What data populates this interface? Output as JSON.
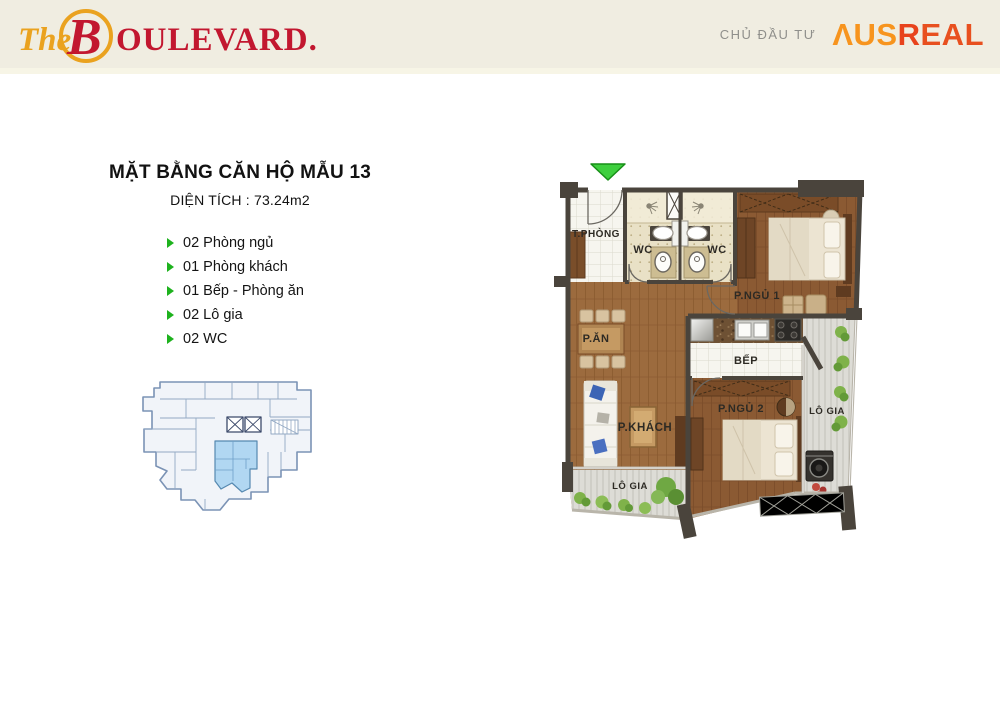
{
  "header": {
    "logo_the": "The",
    "logo_b": "B",
    "logo_rest": "OULEVARD.",
    "developer_label": "CHỦ ĐẦU TƯ",
    "developer_aus": "ΛUS",
    "developer_r": "R",
    "developer_eal": "EAL"
  },
  "title": {
    "main": "MẶT BẰNG CĂN HỘ MẪU 13",
    "area": "DIỆN TÍCH : 73.24m2"
  },
  "features": [
    "02 Phòng ngủ",
    "01 Phòng khách",
    "01 Bếp - Phòng ăn",
    "02 Lô gia",
    "02 WC"
  ],
  "floor_plan": {
    "rooms": {
      "entry": "T.PHÒNG",
      "wc_left": "WC",
      "wc_right": "WC",
      "bedroom1": "P.NGỦ 1",
      "dining": "P.ĂN",
      "kitchen": "BẾP",
      "living": "P.KHÁCH",
      "bedroom2": "P.NGỦ 2",
      "loggia_right": "LÔ GIA",
      "loggia_bottom": "LÔ GIA"
    }
  },
  "colors": {
    "header_bg": "#f0ede1",
    "brand_gold": "#eaa21f",
    "brand_red": "#c2172f",
    "ausreal_orange": "#f7941e",
    "ausreal_red": "#e8431c",
    "bullet_green": "#1eb21e",
    "arrow_green": "#3ecf3e",
    "wall": "#4a443c",
    "wood_floor": "#9c6b3e",
    "unit_highlight": "#aed6f2"
  }
}
